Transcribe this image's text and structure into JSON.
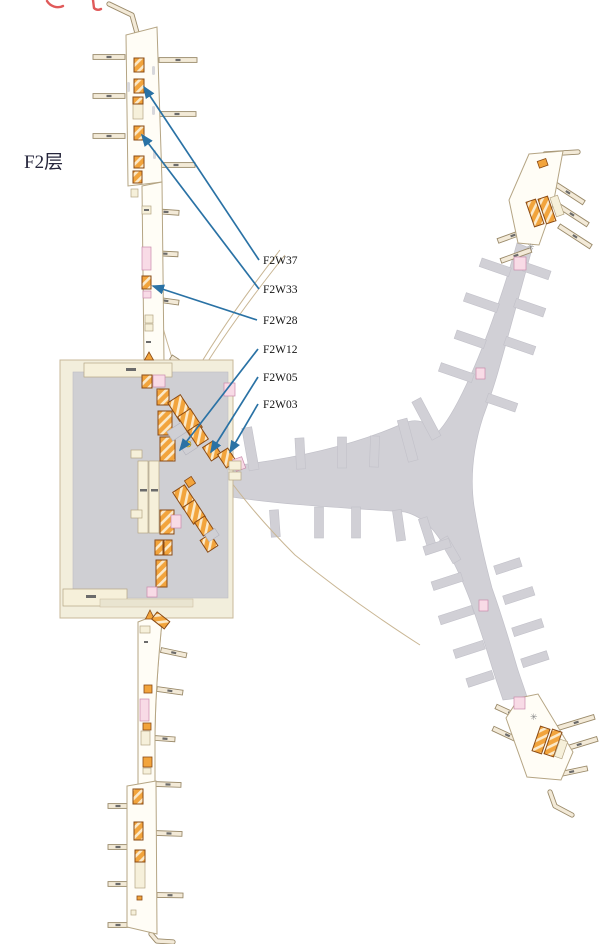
{
  "map": {
    "floor_label": "F2层",
    "annotations": [
      {
        "id": "F2W37",
        "label": "F2W37"
      },
      {
        "id": "F2W33",
        "label": "F2W33"
      },
      {
        "id": "F2W28",
        "label": "F2W28"
      },
      {
        "id": "F2W12",
        "label": "F2W12"
      },
      {
        "id": "F2W05",
        "label": "F2W05"
      },
      {
        "id": "F2W03",
        "label": "F2W03"
      }
    ],
    "colors": {
      "leader_blue": "#2a72a5",
      "shop_orange": "#f2a43c",
      "shop_border": "#8a4a14",
      "concourse_gray": "#d1d0d6",
      "landside_cream": "#f2eedc",
      "bridge_tan": "#f3ead8",
      "facility_pink": "#f8dbe6",
      "partial_title_red": "#e05a5a"
    }
  }
}
